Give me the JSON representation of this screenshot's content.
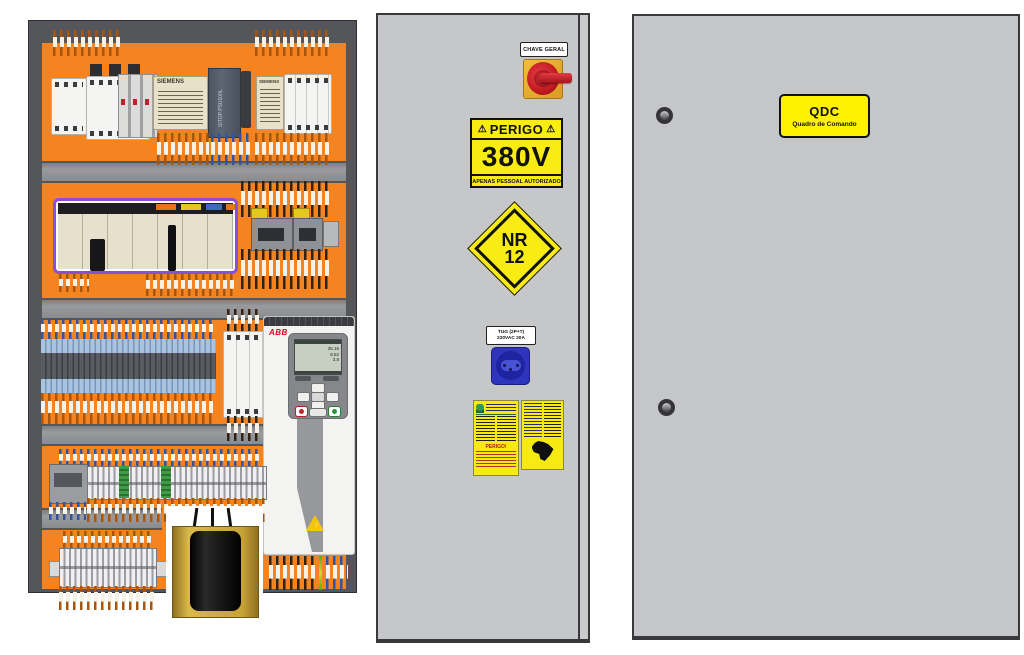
{
  "open_panel": {
    "row1": {
      "siemens1_label": "SIEMENS",
      "siemens2_label": "SIEMENS",
      "psu_label": "SITOP PSU100L"
    },
    "vfd": {
      "brand": "ABB",
      "lcd_values": [
        "35.16",
        "8.52",
        "3.8"
      ],
      "warning_icon": "⚡"
    }
  },
  "door": {
    "main_switch_label": "CHAVE GERAL",
    "danger_label": {
      "warning_icon": "⚠",
      "title": "PERIGO",
      "voltage": "380V",
      "subtitle": "APENAS PESSOAL AUTORIZADO"
    },
    "nr12_sign": {
      "line1": "NR",
      "line2": "12"
    },
    "socket_label": {
      "line1": "TUG (2P+T)",
      "line2": "220VAC 20A"
    },
    "nameplate_left": {
      "warning": "PERIGO!"
    }
  },
  "cabinet": {
    "qdc_label": {
      "title": "QDC",
      "subtitle": "Quadro de Comando"
    }
  },
  "colors": {
    "mounting_plate_orange": "#F5831F",
    "enclosure_gray": "#C6C7C9",
    "label_yellow": "#F8EC12",
    "abb_red": "#E2001A"
  }
}
